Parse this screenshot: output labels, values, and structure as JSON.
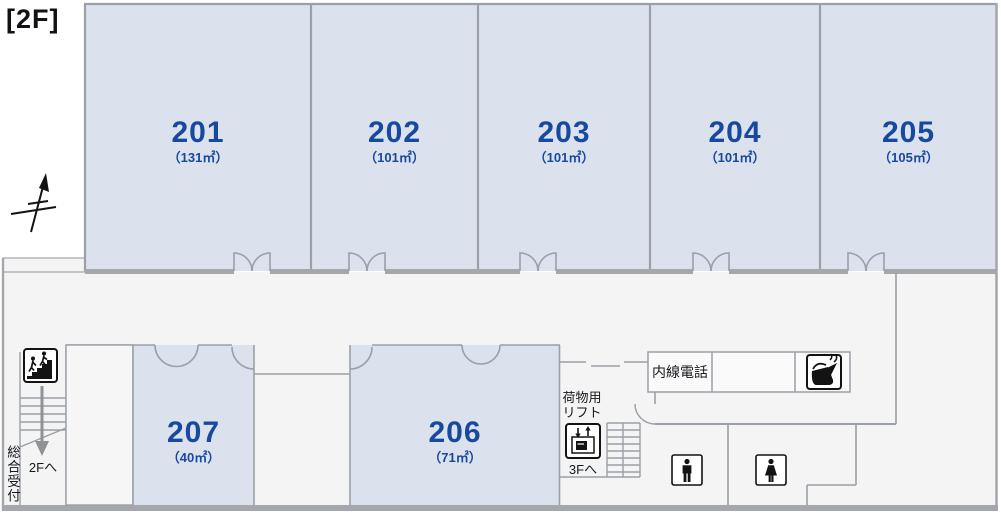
{
  "labels": {
    "floor": "[2F]",
    "intercom": "内線電話",
    "cargo_lift": [
      "荷物用",
      "リフト"
    ],
    "to_3f": "3Fへ",
    "to_2f": "2Fへ",
    "reception": "総合受付"
  },
  "rooms": [
    {
      "number": "201",
      "area": "（131㎡）"
    },
    {
      "number": "202",
      "area": "（101㎡）"
    },
    {
      "number": "203",
      "area": "（101㎡）"
    },
    {
      "number": "204",
      "area": "（101㎡）"
    },
    {
      "number": "205",
      "area": "（105㎡）"
    },
    {
      "number": "206",
      "area": "（71㎡）"
    },
    {
      "number": "207",
      "area": "（40㎡）"
    }
  ],
  "icons": [
    "north-arrow",
    "stairs-pictogram",
    "cargo-lift-pictogram",
    "kettle-pictogram",
    "male-restroom-pictogram",
    "female-restroom-pictogram",
    "down-arrow"
  ],
  "colors": {
    "room_fill": "#dce2ed",
    "room_text": "#17499e",
    "wall": "#9aa0a8",
    "outer_wall": "#a4a7ab",
    "corridor": "#f4f4f5",
    "pictogram": "#111111"
  }
}
